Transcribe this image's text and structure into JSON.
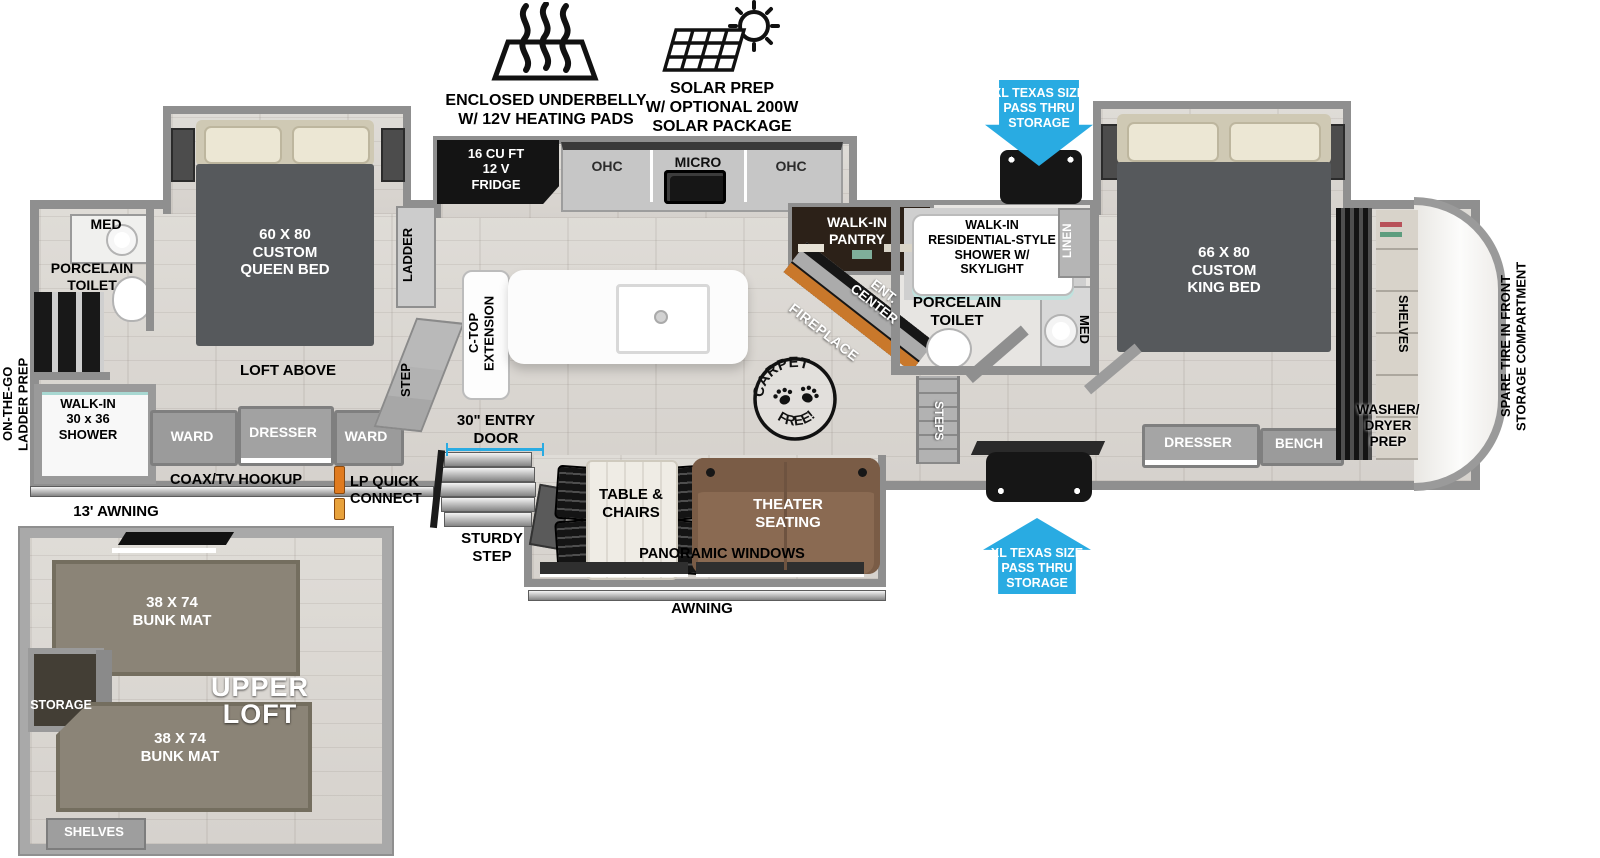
{
  "features": {
    "underbelly": "ENCLOSED UNDERBELLY\nW/ 12V HEATING PADS",
    "solar": "SOLAR PREP\nW/ OPTIONAL 200W\nSOLAR PACKAGE"
  },
  "pass_thru": {
    "label": "XL TEXAS SIZE\nPASS THRU\nSTORAGE"
  },
  "rear_bath": {
    "med": "MED",
    "toilet": "PORCELAIN\nTOILET",
    "shower": "WALK-IN\n30 x 36\nSHOWER",
    "ladder_prep": "ON-THE-GO\nLADDER PREP"
  },
  "bedroom": {
    "bed": "60 X 80\nCUSTOM\nQUEEN BED",
    "loft_above": "LOFT ABOVE",
    "ward": "WARD",
    "dresser": "DRESSER",
    "ladder": "LADDER",
    "step": "STEP"
  },
  "kitchen": {
    "fridge": "16 CU FT\n12 V\nFRIDGE",
    "ohc": "OHC",
    "micro": "MICRO",
    "ctop": "C-TOP\nEXTENSION"
  },
  "living": {
    "pantry": "WALK-IN\nPANTRY",
    "ent_center": "ENT.\nCENTER",
    "fireplace": "FIREPLACE",
    "carpet_top": "CARPET",
    "carpet_bottom": "FREE!",
    "table_chairs": "TABLE &\nCHAIRS",
    "theater": "THEATER\nSEATING",
    "panoramic": "PANORAMIC WINDOWS",
    "awning": "AWNING"
  },
  "entry": {
    "door": "30\" ENTRY\nDOOR",
    "sturdy_step": "STURDY\nSTEP",
    "coax": "COAX/TV HOOKUP",
    "lp": "LP QUICK\nCONNECT",
    "awning13": "13' AWNING"
  },
  "center_bath": {
    "shower": "WALK-IN\nRESIDENTIAL-STYLE\nSHOWER W/\nSKYLIGHT",
    "toilet": "PORCELAIN\nTOILET",
    "linen": "LINEN",
    "med": "MED",
    "steps": "STEPS"
  },
  "master": {
    "bed": "66 X 80\nCUSTOM\nKING BED",
    "dresser": "DRESSER",
    "bench": "BENCH"
  },
  "front": {
    "shelves": "SHELVES",
    "washer": "WASHER/\nDRYER\nPREP",
    "spare_tire": "SPARE TIRE IN FRONT\nSTORAGE COMPARTMENT"
  },
  "loft": {
    "bunk": "38 X 74\nBUNK MAT",
    "title": "UPPER\nLOFT",
    "storage": "STORAGE",
    "shelves": "SHELVES"
  },
  "colors": {
    "accent_blue": "#29ABE2",
    "fireplace_orange": "#C9782B",
    "theater_brown": "#8A6A52",
    "bunk_gray": "#8B8477"
  }
}
